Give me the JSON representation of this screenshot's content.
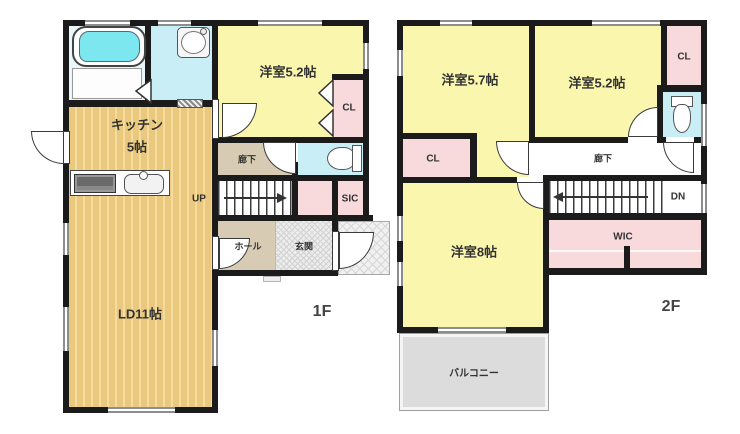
{
  "plan_type": "floor-plan",
  "floor1": {
    "floor_label": "1F",
    "kitchen_name": "キッチン",
    "kitchen_size": "5帖",
    "living_dining": "LD11帖",
    "bedroom_52": "洋室5.2帖",
    "corridor": "廊下",
    "closet": "CL",
    "shoe_closet": "SIC",
    "hall": "ホール",
    "entrance": "玄関",
    "stairs_up": "UP"
  },
  "floor2": {
    "floor_label": "2F",
    "bedroom_57": "洋室5.7帖",
    "bedroom_52": "洋室5.2帖",
    "bedroom_8": "洋室8帖",
    "closet_left": "CL",
    "closet_right": "CL",
    "corridor": "廊下",
    "stairs_down": "DN",
    "walk_in_closet": "WIC",
    "balcony": "バルコニー"
  },
  "colors": {
    "wall": "#1b1b1b",
    "yellow": "#faf6ae",
    "pink": "#f8d9dc",
    "water": "#c9eef6",
    "tubWater": "#7de7f0",
    "wood": "#eac87e",
    "woodStripe": "#f4dc9f",
    "beige": "#d7ccb3",
    "balcony": "#dcdcdc"
  }
}
